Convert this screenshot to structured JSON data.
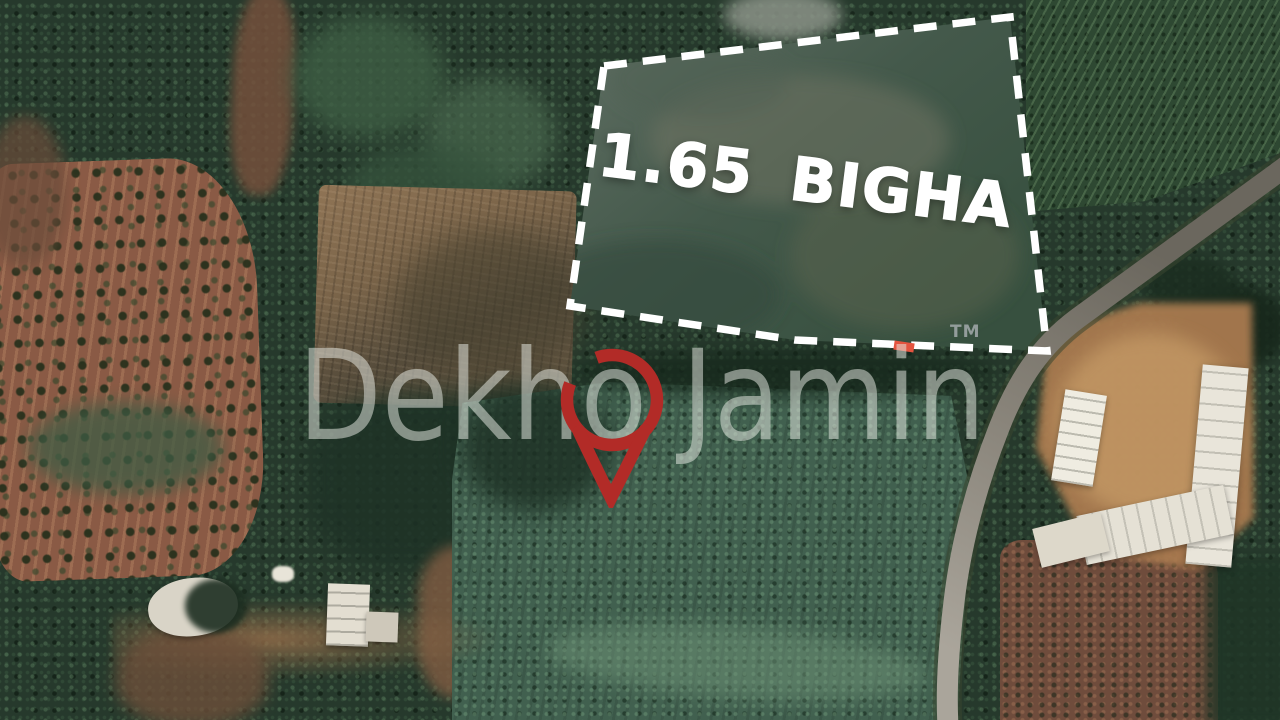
{
  "land_plot": {
    "area_label": "1.65 BIGHA"
  },
  "watermark": {
    "brand_text": "Dekho Jamin",
    "trademark_text": "TM",
    "pin_icon": "location-pin-icon"
  },
  "colors": {
    "boundary_dash": "#ffffff",
    "boundary_red_dash": "#e4543f",
    "pin_red": "#b22b27",
    "area_label_text": "#ffffff",
    "watermark_text": "#e7eae3",
    "trademark_text": "#98a1a0"
  }
}
